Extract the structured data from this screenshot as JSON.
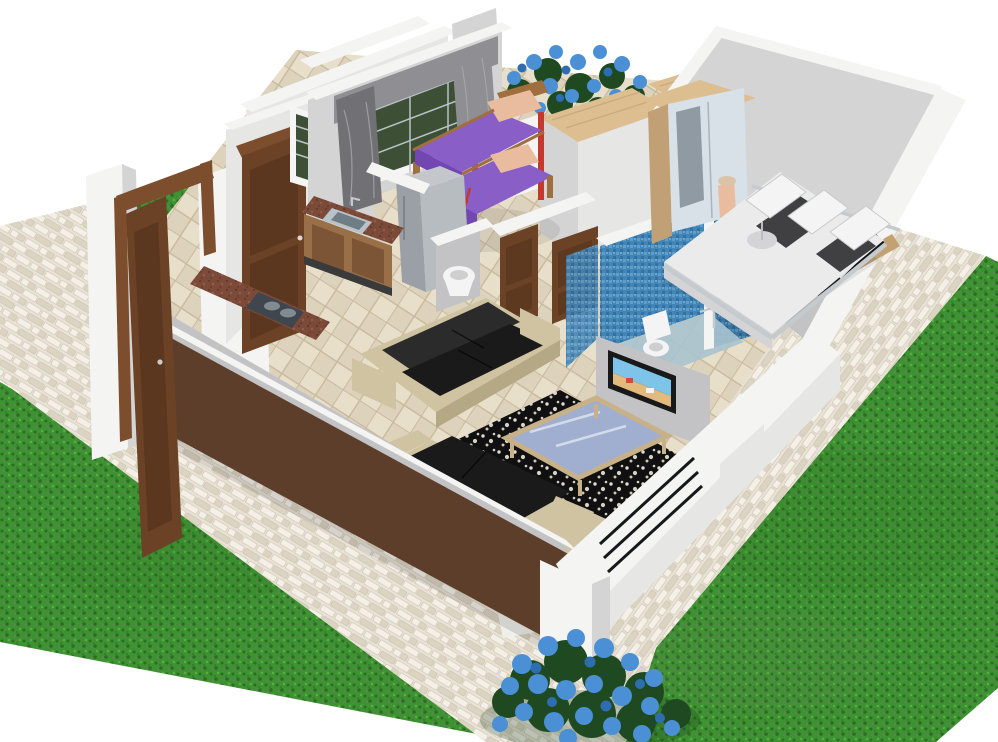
{
  "scene": {
    "type": "3d-floorplan-render",
    "description": "Isometric cutaway 3D render of a small house floor plan with surrounding lawn and stone walkways",
    "rooms": [
      "entrance-porch",
      "kitchen",
      "kids-bedroom",
      "hallway",
      "bathroom",
      "shower-room",
      "master-bedroom",
      "living-room"
    ],
    "furniture": [
      "bunk-bed",
      "kitchen-counter",
      "gas-hob",
      "kitchen-sink",
      "refrigerator",
      "wardrobe-with-mirror",
      "double-bed",
      "bedside-lamp",
      "toilet",
      "shower",
      "corner-basin",
      "sofa",
      "loveseat",
      "coffee-table",
      "area-rug",
      "wall-tv",
      "pedestal-vase",
      "flower-planter"
    ],
    "exterior": [
      "lawn",
      "stone-walkway",
      "brown-parapet-wall",
      "entrance-door",
      "blue-flower-bushes"
    ]
  },
  "palette": {
    "background": "#ffffff",
    "grass_base": "#3f9233",
    "grass_dark": "#2b6d22",
    "grass_light": "#57b13e",
    "grass_gray": "#6e7d60",
    "stone_base": "#e9e3d6",
    "stone_light": "#f5f0e7",
    "stone_mid": "#dcd4c3",
    "stone_line": "#c7beab",
    "tile_base": "#ddd2bb",
    "tile_light": "#e8dfca",
    "tile_line": "#c9bb9f",
    "wall_white": "#f4f4f3",
    "wall_light": "#e6e6e5",
    "wall_mid": "#d4d4d4",
    "wall_dark": "#c3c3c5",
    "wall_deep": "#b4b4b7",
    "room_glow": "#fbfbfb",
    "parapet_brown": "#5d3e2b",
    "door_frame": "#7d4e2e",
    "door_brown": "#6b4226",
    "door_brown_dark": "#50301a",
    "counter_granite": "#7c4a38",
    "granite_dark": "#5e352a",
    "granite_light": "#935c48",
    "cabinet_wood": "#996f47",
    "cabinet_panel": "#7b5535",
    "kick_dark": "#3a3a3a",
    "steel": "#b9c2c7",
    "steel_dark": "#6f7d84",
    "hob_dark": "#3f464d",
    "burner_gray": "#818b94",
    "fridge_gray": "#9aa0a6",
    "fridge_light": "#b7bcc1",
    "fridge_top": "#c3c7cb",
    "bunk_purple": "#8a5ec7",
    "bunk_purple_dark": "#7347b1",
    "bunk_frame": "#a06f3e",
    "ladder_red": "#c23a2d",
    "pillow_pink": "#e9bb9f",
    "curtain_gray": "#8f8f93",
    "curtain_dark": "#707075",
    "shutter_green": "#3d5036",
    "glass_bar": "#b9c2c7",
    "frame_white": "#f5f5f5",
    "wood_top": "#dcbe90",
    "wood_grain": "#c2a172",
    "flower_blue": "#4b8fd4",
    "flower_blue_dark": "#2f6db1",
    "leaf_green": "#1f4a21",
    "leaf_dark": "#153818",
    "sofa_beige": "#cfc3a2",
    "sofa_beige_dark": "#b5a884",
    "cushion_black": "#1a1a1a",
    "cushion_deep": "#0f0f0f",
    "cushion_soft": "#2b2b2b",
    "rug_black": "#101010",
    "rug_white": "#ece5d8",
    "table_wood": "#c8b187",
    "table_glass": "#a0aed0",
    "tv_frame": "#191919",
    "tv_sky": "#7ec3e8",
    "tv_sand": "#e2ba7e",
    "tv_boat": "#d04b3a",
    "bath_blue": "#4286b8",
    "bath_blue_dark": "#2e6c9c",
    "bath_blue_light": "#79b1d4",
    "bath_floor": "#a9c3cf",
    "fixture_white": "#f3f4f3",
    "fixture_shadow": "#cfcfcf",
    "chrome": "#c4cacd",
    "bed_white": "#ebebeb",
    "bed_shadow": "#d4d4d6",
    "bed_black": "#2e2e30",
    "wardrobe_wood": "#c1a075",
    "mirror": "#d8e1e7",
    "mirror_dark": "#55606a",
    "railing_black": "#17181a",
    "pedestal_white": "#efefec",
    "pedestal_dark": "#8a8a88"
  }
}
